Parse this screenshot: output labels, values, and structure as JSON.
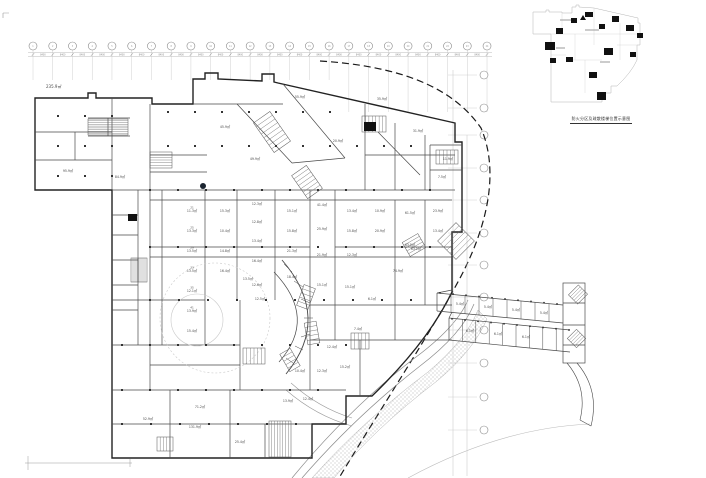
{
  "drawing": {
    "type": "architectural-floor-plan",
    "colors": {
      "background": "#ffffff",
      "outline": "#222222",
      "wall": "#4a4a4a",
      "light": "#b0b0b0",
      "grid": "#888888",
      "label": "#4a4a4a",
      "core_fill": "#111111",
      "boundary_dash": "#1a1a1a"
    }
  },
  "inset": {
    "caption": "防火分区及疏散楼梯位置示意图",
    "core_marks": [
      [
        545,
        42,
        10,
        8
      ],
      [
        556,
        28,
        7,
        6
      ],
      [
        571,
        18,
        6,
        5
      ],
      [
        585,
        12,
        8,
        5
      ],
      [
        599,
        24,
        6,
        5
      ],
      [
        612,
        16,
        7,
        6
      ],
      [
        626,
        25,
        8,
        6
      ],
      [
        637,
        33,
        6,
        5
      ],
      [
        604,
        48,
        9,
        7
      ],
      [
        589,
        72,
        8,
        6
      ],
      [
        597,
        92,
        9,
        8
      ],
      [
        566,
        57,
        7,
        5
      ],
      [
        630,
        52,
        6,
        5
      ],
      [
        550,
        58,
        6,
        5
      ]
    ]
  },
  "labels": {
    "site_area": "235.9㎡"
  },
  "grid": {
    "top": {
      "count": 24,
      "x0": 33,
      "spacing": 19.74,
      "bubble_y": 46,
      "dim_text": "8400"
    },
    "right": {
      "x_bubble": 484,
      "ys": [
        75,
        108,
        135,
        168,
        200,
        233,
        265,
        297,
        330,
        363,
        397,
        430
      ]
    }
  },
  "rooms": [
    {
      "n": "21",
      "t": "11.3㎡",
      "x": 192,
      "y": 212
    },
    {
      "n": "25",
      "t": "13.3㎡",
      "x": 192,
      "y": 232
    },
    {
      "n": "29",
      "t": "13.5㎡",
      "x": 192,
      "y": 252
    },
    {
      "n": "33",
      "t": "13.5㎡",
      "x": 192,
      "y": 272
    },
    {
      "n": "35",
      "t": "12.1㎡",
      "x": 192,
      "y": 292
    },
    {
      "n": "41",
      "t": "13.9㎡",
      "x": 192,
      "y": 312
    },
    {
      "t": "15.4㎡",
      "x": 192,
      "y": 332
    },
    {
      "t": "15.3㎡",
      "x": 225,
      "y": 212
    },
    {
      "t": "10.4㎡",
      "x": 225,
      "y": 232
    },
    {
      "t": "14.8㎡",
      "x": 225,
      "y": 252
    },
    {
      "t": "16.4㎡",
      "x": 225,
      "y": 272
    },
    {
      "t": "12.3㎡",
      "x": 257,
      "y": 205
    },
    {
      "t": "12.8㎡",
      "x": 257,
      "y": 223
    },
    {
      "t": "13.4㎡",
      "x": 257,
      "y": 242
    },
    {
      "t": "16.4㎡",
      "x": 257,
      "y": 262
    },
    {
      "t": "12.6㎡",
      "x": 257,
      "y": 286
    },
    {
      "t": "15.1㎡",
      "x": 292,
      "y": 212
    },
    {
      "t": "15.8㎡",
      "x": 292,
      "y": 232
    },
    {
      "t": "21.3㎡",
      "x": 292,
      "y": 252
    },
    {
      "t": "18.4㎡",
      "x": 292,
      "y": 278
    },
    {
      "t": "41.4㎡",
      "x": 322,
      "y": 206
    },
    {
      "t": "25.9㎡",
      "x": 322,
      "y": 230
    },
    {
      "t": "21.9㎡",
      "x": 322,
      "y": 256
    },
    {
      "t": "15.1㎡",
      "x": 322,
      "y": 286
    },
    {
      "t": "13.4㎡",
      "x": 352,
      "y": 212
    },
    {
      "t": "15.8㎡",
      "x": 352,
      "y": 232
    },
    {
      "t": "12.3㎡",
      "x": 352,
      "y": 256
    },
    {
      "t": "10.9㎡",
      "x": 380,
      "y": 212
    },
    {
      "t": "20.9㎡",
      "x": 380,
      "y": 232
    },
    {
      "t": "61.5㎡",
      "x": 410,
      "y": 214
    },
    {
      "t": "63.5㎡",
      "x": 410,
      "y": 246
    },
    {
      "t": "23.9㎡",
      "x": 438,
      "y": 212
    },
    {
      "t": "13.4㎡",
      "x": 438,
      "y": 232
    },
    {
      "t": "84.9㎡",
      "x": 120,
      "y": 178
    },
    {
      "t": "95.9㎡",
      "x": 68,
      "y": 172
    },
    {
      "t": "45.9㎡",
      "x": 225,
      "y": 128
    },
    {
      "t": "55.9㎡",
      "x": 300,
      "y": 98
    },
    {
      "t": "35.9㎡",
      "x": 382,
      "y": 100
    },
    {
      "t": "20.9㎡",
      "x": 338,
      "y": 142
    },
    {
      "t": "31.9㎡",
      "x": 418,
      "y": 132
    },
    {
      "t": "49.9㎡",
      "x": 255,
      "y": 160
    },
    {
      "t": "11.9㎡",
      "x": 448,
      "y": 160
    },
    {
      "t": "7.5㎡",
      "x": 442,
      "y": 178
    },
    {
      "t": "15.1㎡",
      "x": 350,
      "y": 288
    },
    {
      "t": "6.1㎡",
      "x": 372,
      "y": 300
    },
    {
      "t": "74.9㎡",
      "x": 398,
      "y": 272
    },
    {
      "t": "63.1㎡",
      "x": 416,
      "y": 250
    },
    {
      "t": "7.4㎡",
      "x": 358,
      "y": 330
    },
    {
      "t": "12.4㎡",
      "x": 332,
      "y": 348
    },
    {
      "t": "10.4㎡",
      "x": 300,
      "y": 372
    },
    {
      "t": "12.3㎡",
      "x": 322,
      "y": 372
    },
    {
      "t": "15.2㎡",
      "x": 345,
      "y": 368
    },
    {
      "t": "13.9㎡",
      "x": 288,
      "y": 402
    },
    {
      "t": "12.4㎡",
      "x": 308,
      "y": 400
    },
    {
      "t": "131.9㎡",
      "x": 195,
      "y": 428
    },
    {
      "t": "52.9㎡",
      "x": 148,
      "y": 420
    },
    {
      "t": "25.4㎡",
      "x": 240,
      "y": 443
    },
    {
      "t": "71.2㎡",
      "x": 200,
      "y": 408
    },
    {
      "t": "12.5㎡",
      "x": 260,
      "y": 300
    },
    {
      "t": "13.5㎡",
      "x": 248,
      "y": 280
    },
    {
      "t": "5.4㎡",
      "x": 460,
      "y": 305
    },
    {
      "t": "5.4㎡",
      "x": 488,
      "y": 308
    },
    {
      "t": "5.4㎡",
      "x": 516,
      "y": 311
    },
    {
      "t": "5.4㎡",
      "x": 544,
      "y": 314
    },
    {
      "t": "6.1㎡",
      "x": 470,
      "y": 332
    },
    {
      "t": "6.1㎡",
      "x": 498,
      "y": 335
    },
    {
      "t": "6.1㎡",
      "x": 526,
      "y": 338
    }
  ]
}
